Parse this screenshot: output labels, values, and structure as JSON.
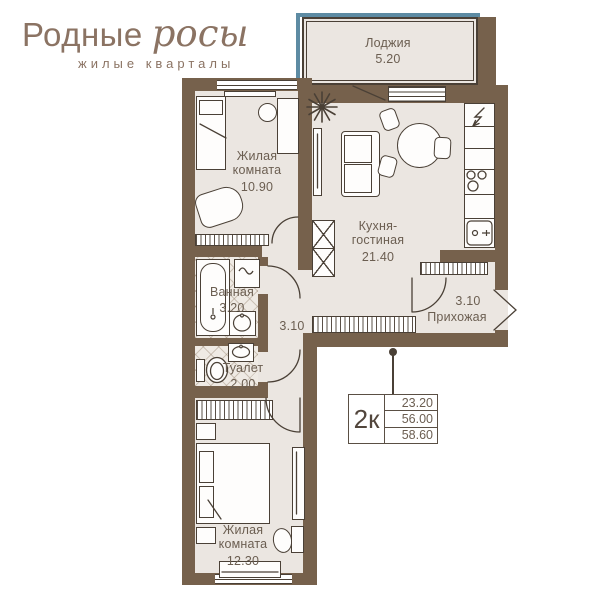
{
  "logo": {
    "brand_regular": "Родные",
    "brand_script": "росы",
    "subtitle": "жилые кварталы"
  },
  "rooms": {
    "loggia": {
      "name": "Лоджия",
      "area": "5.20"
    },
    "bedroom1": {
      "name": "Жилая комната",
      "area": "10.90"
    },
    "kitchen": {
      "name": "Кухня-гостиная",
      "area": "21.40"
    },
    "bathroom": {
      "name": "Ванная",
      "area": "3.20"
    },
    "corridor": {
      "area": "3.10"
    },
    "toilet": {
      "name": "Туалет",
      "area": "2.00"
    },
    "hallway": {
      "name": "Прихожая",
      "area": "3.10"
    },
    "bedroom2": {
      "name": "Жилая комната",
      "area": "12.30"
    }
  },
  "info_box": {
    "type_label": "2к",
    "living_area": "23.20",
    "floor_area": "56.00",
    "total_area": "58.60"
  },
  "colors": {
    "wall": "#76614c",
    "floor": "#ebe6e1",
    "glazing_teal": "#5d8ba3",
    "logo_brown": "#8b7363",
    "line_dark": "#4a4036",
    "label_text": "#6b5e51"
  }
}
